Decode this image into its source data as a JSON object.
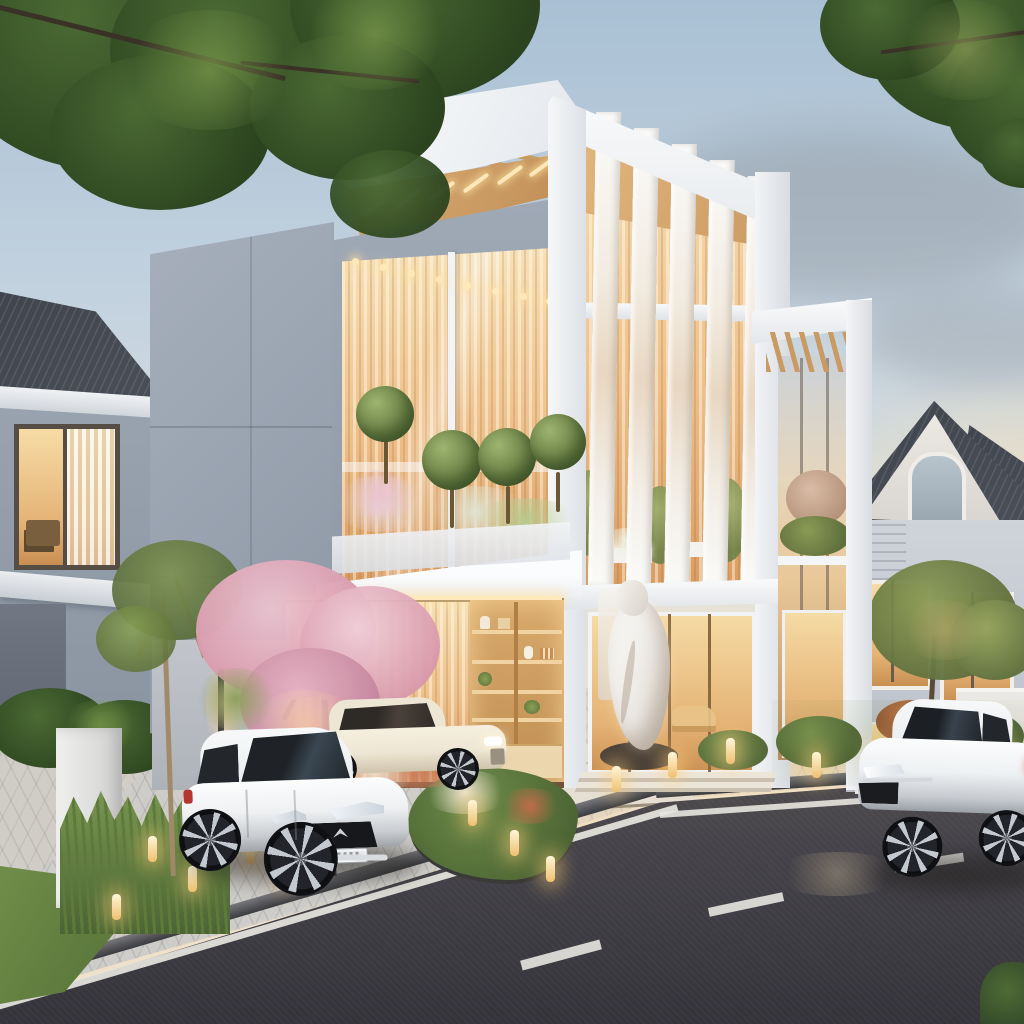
{
  "scene": {
    "alt": "Dusk architectural rendering of a modern white two-storey villa with vertical louver fins, wood soffits, sheer glowing curtains and a lit display-shelf carport; classic grey neighbouring houses on both sides; landscaped front garden with bollard lights, a pink flowering tree, a white hatchback and a cream sedan parked on the paver driveway, and a white sedan driving past on the dark asphalt road with white lane markings.",
    "time_of_day": "dusk",
    "elements": [
      "sky",
      "clouds",
      "overhanging-tree-left",
      "overhanging-tree-right",
      "left-neighbor-house",
      "right-neighbor-house",
      "main-house",
      "louver-fins",
      "wood-soffit",
      "sheer-curtain-glazing",
      "balcony-planters",
      "topiary-trees",
      "carport",
      "display-shelves",
      "entrance-statue",
      "small-pergola",
      "driveway-pavers",
      "walkway-slabs",
      "garden-beds",
      "bollard-lights",
      "pink-flowering-tree",
      "lawn",
      "curb",
      "asphalt-road",
      "road-markings",
      "white-hatchback",
      "cream-sedan",
      "white-sedan-on-road"
    ]
  },
  "colors": {
    "sky-top": "#a9c0d4",
    "sky-mid": "#c6d4e0",
    "sky-low": "#e4e2d8",
    "sky-warm": "#f2e3cc",
    "cloud-gray": "#8a9096",
    "cloud-warm": "#f6ead6",
    "white-hi": "#fafbfc",
    "white-sh": "#dfe3e8",
    "bluegray": "#9aa4b1",
    "bluegray-dk": "#7f8996",
    "wood": "#c99a62",
    "wood-lt": "#e3b87f",
    "glow-hi": "#f7e1b6",
    "glow-md": "#eec089",
    "glow-dp": "#d89a5e",
    "green-dk": "#2c431f",
    "green-md": "#4a6a33",
    "green-lt": "#7c9a4c",
    "grass": "#718e49",
    "grass-dk": "#4f6b35",
    "pink": "#eac3cf",
    "pink-dk": "#d897ab",
    "paver": "#d0cdc8",
    "paver-warm": "#e6d8c4",
    "road": "#46444a",
    "road-dk": "#34333a",
    "curb": "#77777c",
    "line-w": "#e8e6e0",
    "roof-dk": "#4a4f58",
    "wall-gray": "#99a3af",
    "house-r-wall": "#cfd3da",
    "statue": "#ece9e4",
    "car-white": "#f4f6f8",
    "car-cream": "#eee6d4",
    "lamp": "#ffe9bb"
  }
}
